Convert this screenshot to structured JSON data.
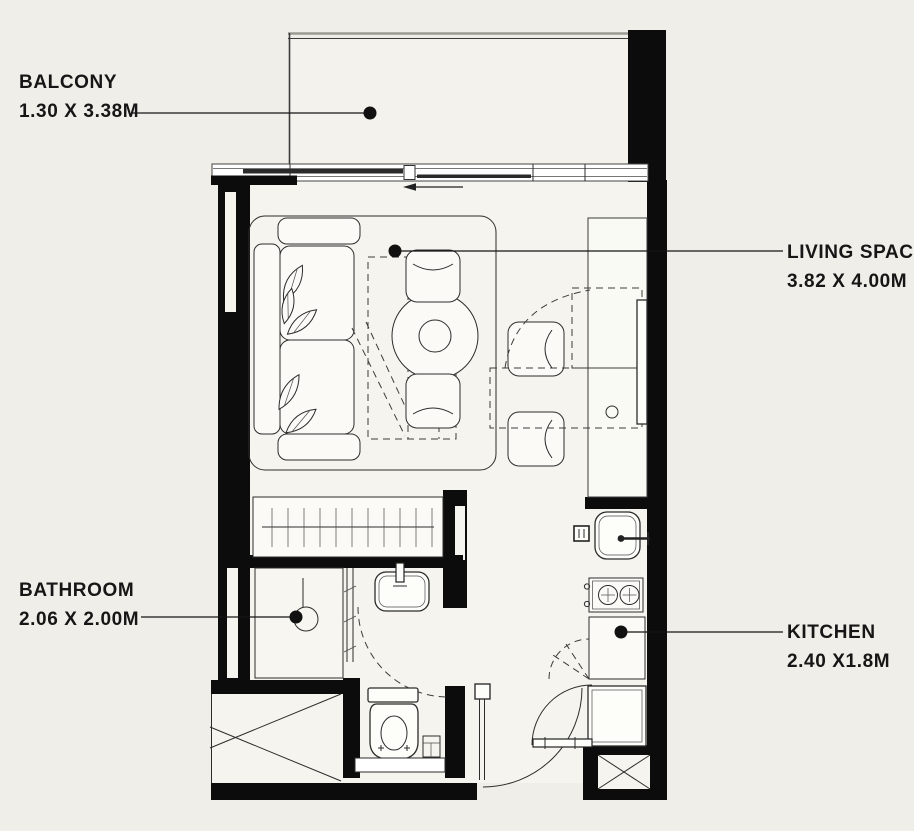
{
  "floor_plan": {
    "type": "studio-apartment-floor-plan",
    "rooms": [
      {
        "id": "balcony",
        "label": "BALCONY",
        "dimensions": "1.30 X 3.38M"
      },
      {
        "id": "living_space",
        "label": "LIVING SPACE",
        "dimensions": "3.82 X 4.00M"
      },
      {
        "id": "bathroom",
        "label": "BATHROOM",
        "dimensions": "2.06 X 2.00M"
      },
      {
        "id": "kitchen",
        "label": "KITCHEN",
        "dimensions": "2.40 X1.8M"
      }
    ],
    "colors": {
      "background": "#f0eee8",
      "interior": "#f5f4ee",
      "balcony_interior": "#f4f2ec",
      "wall": "#0c0c0c",
      "line": "#2c2c2c",
      "label_text": "#161616"
    }
  }
}
